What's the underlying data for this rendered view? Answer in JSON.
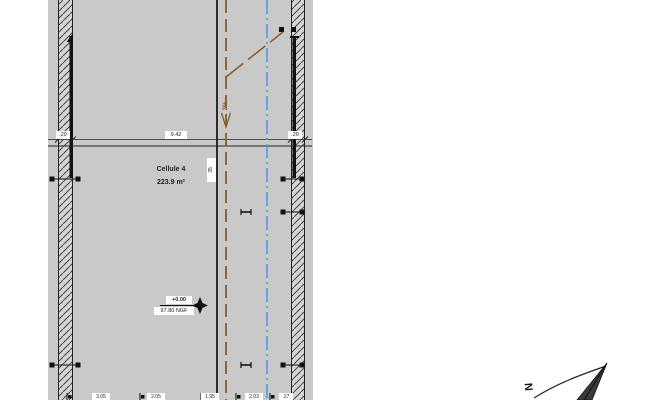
{
  "drawing": {
    "room": {
      "name": "Cellule 4",
      "area": "223.9 m²"
    },
    "level_marker": {
      "relative_level": "+0.00",
      "absolute_level": "97.80 NGF"
    },
    "slope_label": "2%",
    "joint_dimension": "35",
    "dimensions_top": {
      "left_wall": ".20",
      "span": "9.42",
      "right_wall": ".20"
    },
    "dimensions_bottom": [
      "3.05",
      "2.05",
      "1.95",
      "2.03",
      ".27"
    ],
    "compass": {
      "north_label": "N"
    },
    "colors": {
      "plan_background": "#c9c9c9",
      "wall_fill": "#d4d4d4",
      "line": "#1c1c1c",
      "slope_line": "#8a5a2a",
      "axis_line": "#3d96e8"
    }
  }
}
